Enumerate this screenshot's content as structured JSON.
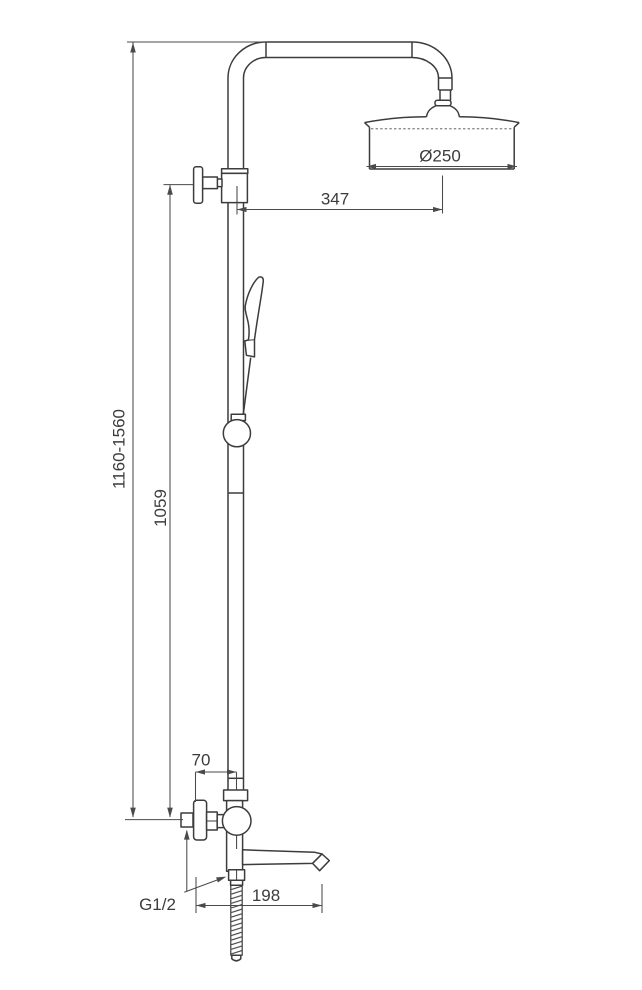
{
  "style": {
    "ink": "#3c3c3c",
    "dimension_ink": "#4a4a4a",
    "background": "#ffffff"
  },
  "labels": {
    "overall_height": "1160-1560",
    "column_height": "1059",
    "arm_projection": "347",
    "head_diameter": "Ø250",
    "handle_offset": "70",
    "spout_projection": "198",
    "connection_thread": "G1/2"
  }
}
